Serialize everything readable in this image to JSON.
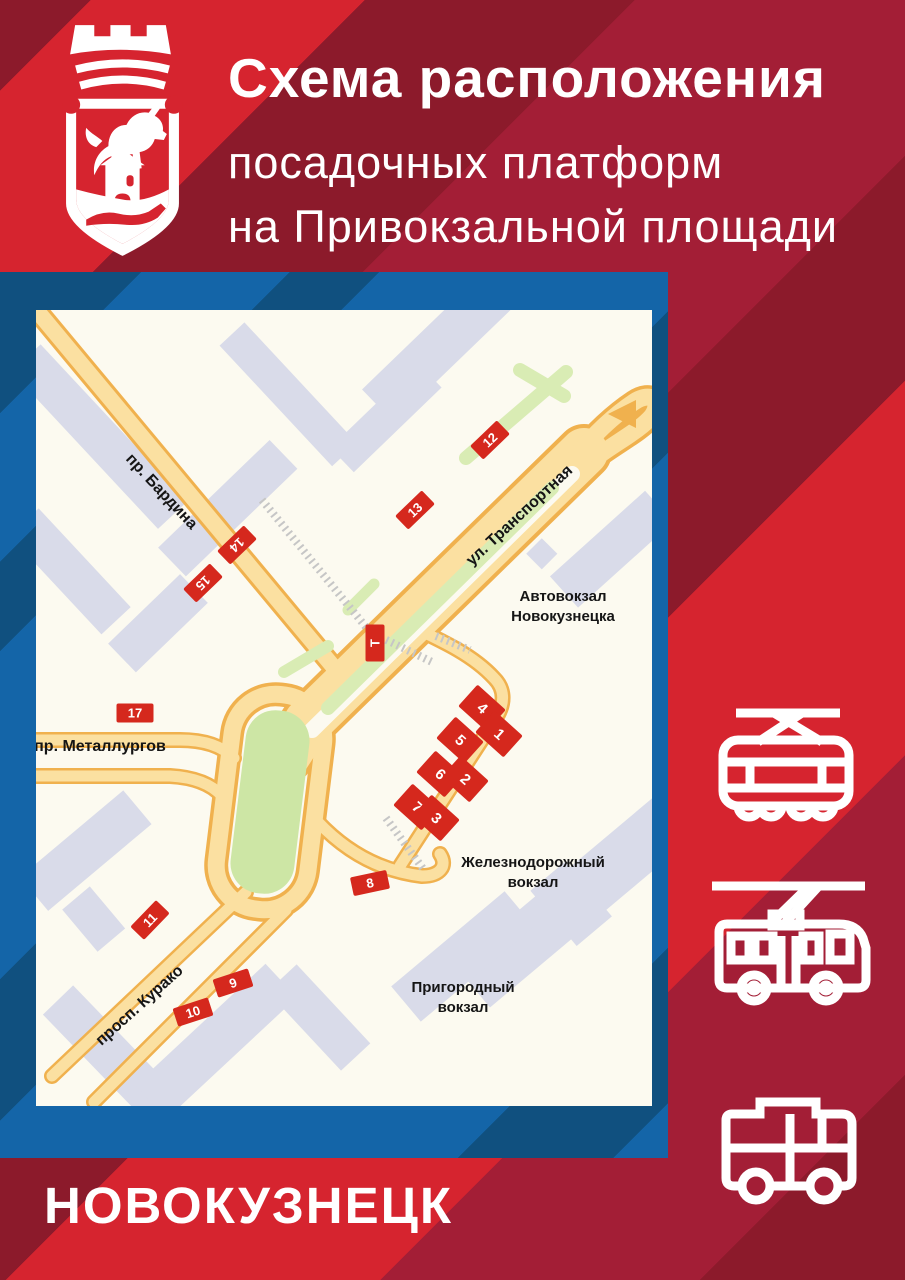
{
  "title": {
    "line1": "Схема расположения",
    "line2": "посадочных платформ",
    "line3": "на Привокзальной площади"
  },
  "city_name": "НОВОКУЗНЕЦК",
  "icons": {
    "crest": "novokuznetsk-coat-of-arms",
    "transport": [
      "tram-icon",
      "trolleybus-icon",
      "bus-icon"
    ]
  },
  "colors": {
    "bright_red": "#D6242F",
    "crimson": "#A31E36",
    "maroon": "#8C1A2B",
    "frame_blue": "#1465A8",
    "frame_navy": "#10507F",
    "map_bg": "#FCFAF0",
    "building": "#D9DBE9",
    "road_fill": "#FBE0A1",
    "road_edge": "#F0B14E",
    "green": "#CDE6A5",
    "marker_red": "#D5281D"
  },
  "map": {
    "street_labels": [
      {
        "text": "пр. Бардина",
        "x": 125,
        "y": 182,
        "rot": 47
      },
      {
        "text": "ул. Транспортная",
        "x": 484,
        "y": 206,
        "rot": -43
      },
      {
        "text": "пр. Металлургов",
        "x": 64,
        "y": 437,
        "rot": 0
      },
      {
        "text": "просп. Курако",
        "x": 104,
        "y": 696,
        "rot": -42
      }
    ],
    "poi_labels": [
      {
        "lines": [
          "Автовокзал",
          "Новокузнецка"
        ],
        "x": 527,
        "y": 297
      },
      {
        "lines": [
          "Железнодорожный",
          "вокзал"
        ],
        "x": 497,
        "y": 563
      },
      {
        "lines": [
          "Пригородный",
          "вокзал"
        ],
        "x": 427,
        "y": 688
      }
    ],
    "markers": {
      "small": [
        {
          "label": "12",
          "x": 454,
          "y": 130,
          "rot": -44
        },
        {
          "label": "13",
          "x": 379,
          "y": 200,
          "rot": -44
        },
        {
          "label": "14",
          "x": 201,
          "y": 235,
          "rot": 136
        },
        {
          "label": "15",
          "x": 167,
          "y": 273,
          "rot": 136
        },
        {
          "label": "Т",
          "x": 339,
          "y": 333,
          "rot": -90
        },
        {
          "label": "17",
          "x": 99,
          "y": 403,
          "rot": 0
        },
        {
          "label": "8",
          "x": 334,
          "y": 573,
          "rot": -12
        },
        {
          "label": "11",
          "x": 114,
          "y": 610,
          "rot": -46
        },
        {
          "label": "9",
          "x": 197,
          "y": 673,
          "rot": -18
        },
        {
          "label": "10",
          "x": 157,
          "y": 702,
          "rot": -18
        }
      ],
      "platform": [
        {
          "label": "4",
          "x": 446,
          "y": 398,
          "rot": -48
        },
        {
          "label": "1",
          "x": 463,
          "y": 424,
          "rot": -48
        },
        {
          "label": "5",
          "x": 424,
          "y": 430,
          "rot": -48
        },
        {
          "label": "2",
          "x": 429,
          "y": 469,
          "rot": -48
        },
        {
          "label": "6",
          "x": 404,
          "y": 464,
          "rot": -48
        },
        {
          "label": "7",
          "x": 381,
          "y": 497,
          "rot": -48
        },
        {
          "label": "3",
          "x": 400,
          "y": 508,
          "rot": -48
        }
      ]
    }
  }
}
